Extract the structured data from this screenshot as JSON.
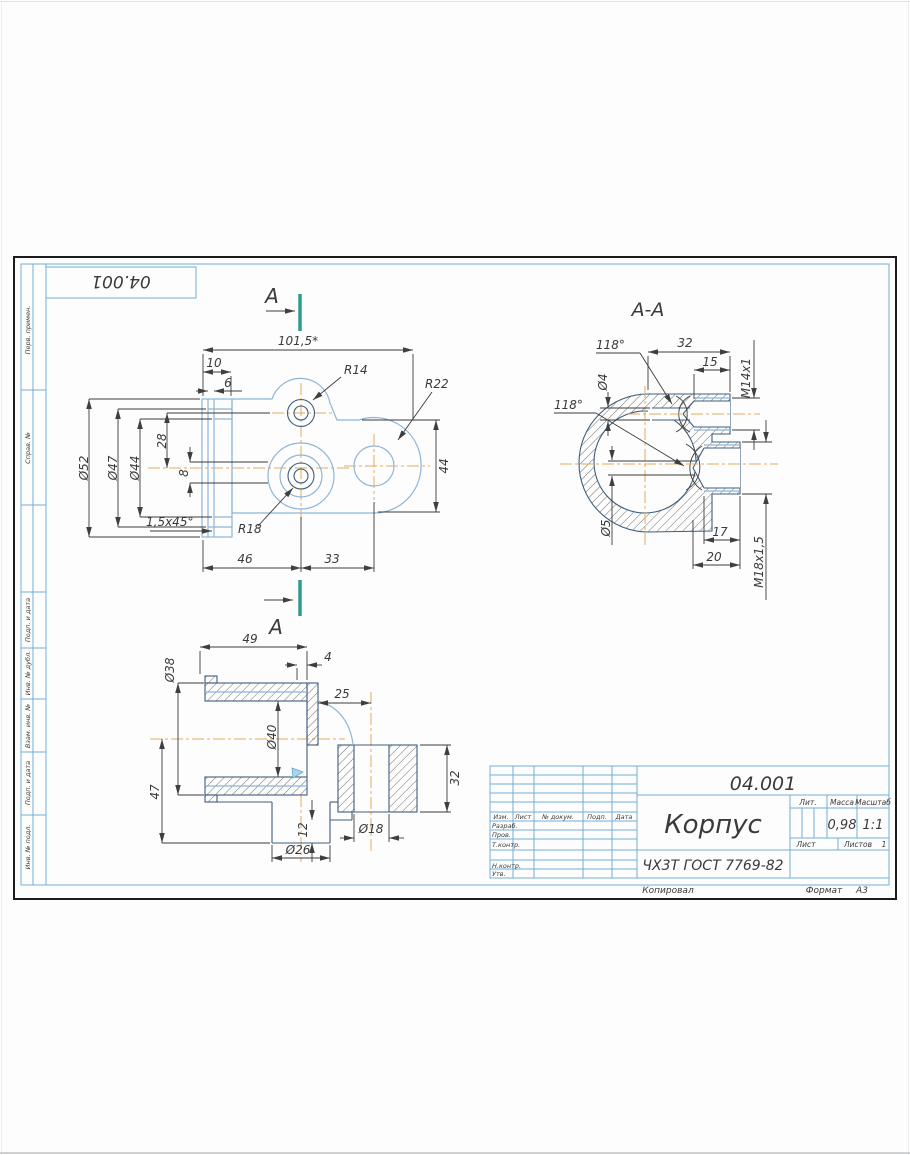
{
  "colors": {
    "frame_blue": "#72aed6",
    "part_light": "#8fb6d8",
    "part_dark": "#3f5e7c",
    "centerline": "#e4aa60",
    "dim_color": "#3a3a3a",
    "section_green": "#2e9c8c",
    "sheet_border": "#1c1c1c"
  },
  "drawing": {
    "designation_top": "04.001",
    "section_letter": "А",
    "side_column_labels": [
      "Перв. примен.",
      "Справ. №",
      "Подп. и дата",
      "Инв. № дубл.",
      "Взам. инв. №",
      "Подп. и дата",
      "Инв. № подл."
    ],
    "views": {
      "plan": {
        "dims": {
          "d1015": "101,5*",
          "d10": "10",
          "d6": "6",
          "d52": "Ø52",
          "d47": "Ø47",
          "d44": "Ø44",
          "d28": "28",
          "d8": "8",
          "chamfer": "1,5х45°",
          "r14": "R14",
          "r22": "R22",
          "r18": "R18",
          "d46": "46",
          "d33": "33",
          "h44": "44"
        }
      },
      "section": {
        "title": "А-А",
        "dims": {
          "a118_top": "118°",
          "a118_left": "118°",
          "d4": "Ø4",
          "d32": "32",
          "d15": "15",
          "m14": "М14х1",
          "d5": "Ø5",
          "d17": "17",
          "d20": "20",
          "m18": "М18х1,5"
        }
      },
      "side": {
        "dims": {
          "d49": "49",
          "d38": "Ø38",
          "d4": "4",
          "d25": "25",
          "d40": "Ø40",
          "d47": "47",
          "d12": "12",
          "d26": "Ø26",
          "d18": "Ø18",
          "d32": "32"
        }
      }
    }
  },
  "title_block": {
    "designation": "04.001",
    "part_name": "Корпус",
    "material": "ЧХ3Т ГОСТ 7769-82",
    "litera_label": "Лит.",
    "mass_label": "Масса",
    "scale_label": "Масштаб",
    "mass_value": "0,98",
    "scale_value": "1:1",
    "sheet_label": "Лист",
    "sheets_label": "Листов",
    "sheets_value": "1",
    "header_cols": [
      "Изм.",
      "Лист",
      "№ докум.",
      "Подп.",
      "Дата"
    ],
    "signature_rows": [
      "Разраб.",
      "Пров.",
      "Т.контр.",
      "Н.контр.",
      "Утв."
    ],
    "footer": {
      "copied": "Копировал",
      "format_label": "Формат",
      "format_value": "А3"
    }
  }
}
